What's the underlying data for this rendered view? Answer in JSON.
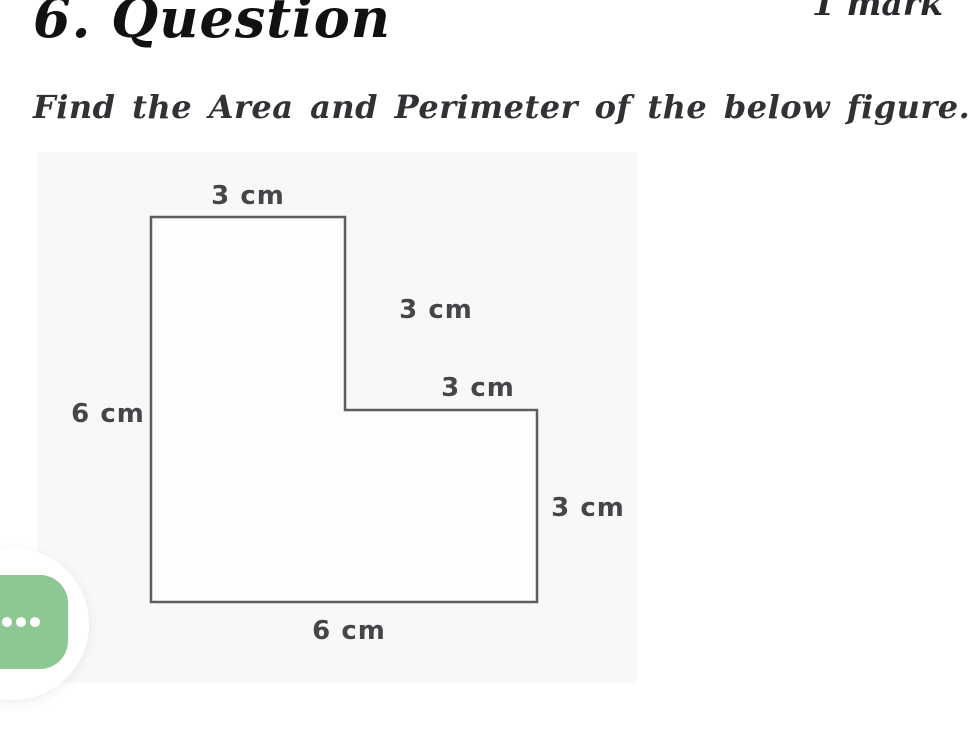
{
  "header": {
    "title": "6. Question",
    "marks": "1 mark"
  },
  "question": {
    "prompt": "Find the Area and Perimeter of the below figure."
  },
  "figure": {
    "type": "L-shaped compound rectangle diagram",
    "unit": "cm",
    "labels": {
      "top": "3 cm",
      "upper_right_side": "3 cm",
      "middle_step": "3 cm",
      "left_side": "6 cm",
      "lower_right_side": "3 cm",
      "bottom": "6 cm"
    }
  },
  "colors": {
    "accent_green": "#8cc794",
    "shape_line": "#5e5e62",
    "label_text": "#46464a",
    "panel_background": "#f8f8f8"
  },
  "fab": {
    "icon": "ellipsis-icon"
  }
}
